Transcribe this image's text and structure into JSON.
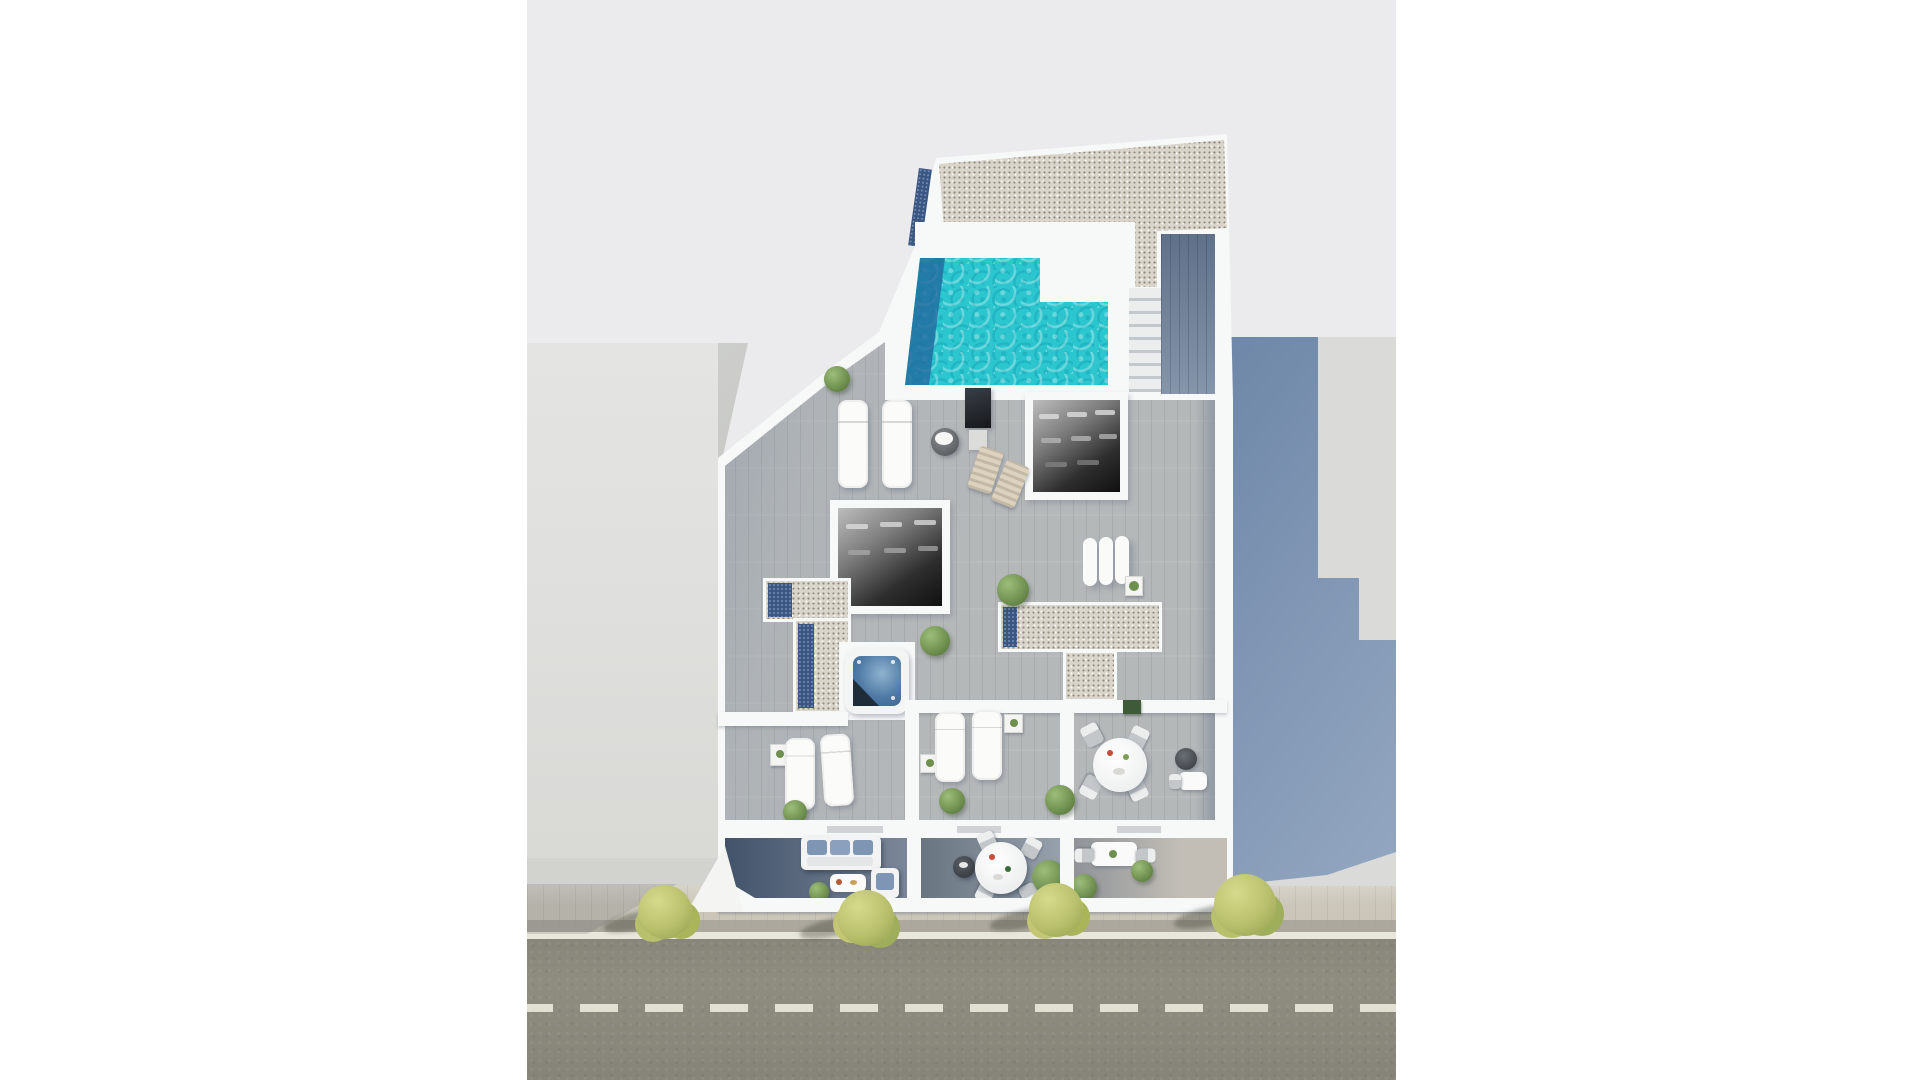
{
  "meta": {
    "title": "Aerial 3D architectural render of a rooftop solarium floor plan",
    "view": "top-down bird's-eye",
    "image_width": 1920,
    "image_height": 1080
  },
  "scene": {
    "labels": {
      "render": "3D aerial render of building rooftop between neighbouring buildings",
      "gravel_roof": "upper gravel roof slab",
      "pool": "L-shaped rooftop swimming pool with turquoise water",
      "pool_deep_end": "dark deep-end band of pool",
      "skylight": "navy glass skylight strip",
      "stairs": "staircase and dark wood walkway beside pool",
      "deck": "grey timber sun deck",
      "room_a": "open-roof interior room (dark)",
      "room_b": "open-roof interior room (dark)",
      "jacuzzi": "square jacuzzi hot tub with folded cover",
      "loungers": "white sun loungers",
      "deck_chairs": "folding beach chairs",
      "mattresses": "three white lounge mattresses",
      "terrace_left": "private terrace with two loungers",
      "terrace_middle": "private terrace with two loungers",
      "terrace_right": "terrace with round dining table and four chairs",
      "balcony_left": "balcony with blue cushioned sofa, armchair and coffee table",
      "balcony_middle": "balcony with round dining table and four chairs",
      "balcony_right": "balcony with rectangular table, two chairs and shrubs",
      "left_building": "neighbouring building roof (left)",
      "right_ground": "neighbouring plot (right) with cast building shadow",
      "sidewalk": "paved sidewalk with street trees",
      "road": "asphalt road with dashed centre line",
      "tv_panel": "dark screen panel on deck",
      "pouf": "round pouf with towels"
    },
    "counts": {
      "sun_loungers": 8,
      "deck_chairs": 2,
      "lounge_mattresses": 3,
      "dining_tables_round": 2,
      "dining_tables_rect": 1,
      "sofas": 1,
      "jacuzzis": 1,
      "pools": 1,
      "street_trees": 4,
      "skylight_strips": 5,
      "dark_rooms": 2,
      "road_dash_count_visible": 13
    }
  },
  "palette": {
    "margin": "#ffffff",
    "bg": "#ebebed",
    "wall": "#f7f8f8",
    "wall_shade": "#dcdddd",
    "gravel": "#d9d5cb",
    "gravel_speck": "#8f897a",
    "skylight_navy": "#3a5683",
    "navy_light": "#7f94b8",
    "pool_water": "#2cc6cf",
    "pool_deep": "#1d5e95",
    "deck": "#b5b8b9",
    "deck_shadow": "#5a6e8a",
    "room_dark": "#141414",
    "jacuzzi_water": "#4f7aa5",
    "sofa_blue": "#7e96b4",
    "bush_green": "#6f8f4f",
    "tree": "#b9c06c",
    "left_building": "#e0e0de",
    "left_building_side": "#c8c9c6",
    "neighbor_ground": "#dadad8",
    "cast_shadow": "#6e87a8",
    "cast_shadow_light": "#94a7c1",
    "sidewalk": "#cbc6b9",
    "sidewalk_dark": "#a9a49a",
    "curb": "#e9e6db",
    "road": "#8f8c80",
    "road_line": "#eae7da"
  }
}
